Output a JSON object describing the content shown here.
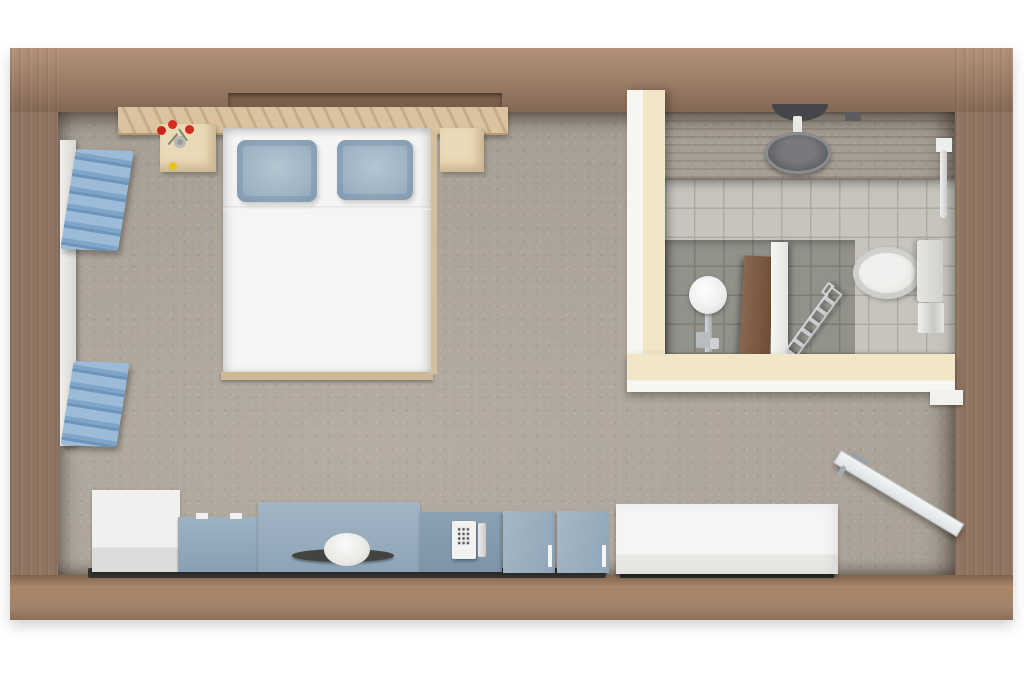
{
  "scene": {
    "type": "3d-floor-plan-top-view",
    "description": "Top-down 3D render of a studio hotel room with bedroom, kitchenette counter, entry door and en-suite bathroom inside a wooden shell",
    "background": "#ffffff"
  },
  "palette": {
    "wall_wood": "#8f7461",
    "wall_wood_light": "#b29178",
    "wall_wood_dark": "#6e5846",
    "floor_carpet": "#aba297",
    "plywood_cream": "#f1e7c7",
    "panel_white": "#f3f3f0",
    "cabinet_blue": "#93aabd",
    "cabinet_blue_dark": "#8196ab",
    "pillow_blue": "#a0b4c4",
    "towel_blue": "#8fb2d3",
    "tile_light": "#c6c4bc",
    "tile_dark": "#92918a",
    "fixture_white": "#eceff0",
    "chrome": "#b9bdc0",
    "flower_red": "#d42a20",
    "flower_yellow": "#e6c31f",
    "headboard_wood": "#dcc3a0",
    "sink_tray_dark": "#434340",
    "bathroom_door_wood": "#7d5a42"
  },
  "rooms": {
    "bedroom": {
      "label": "Bedroom area with double bed"
    },
    "bathroom": {
      "label": "Tiled bathroom with shower, toilet and basin"
    },
    "kitchenette": {
      "label": "Kitchenette counter row along bottom wall"
    },
    "entry": {
      "label": "Entry corner with open door"
    }
  },
  "furniture": {
    "bed": {
      "label": "Double bed with white duvet"
    },
    "pillow_left": {
      "label": "Left blue pillow"
    },
    "pillow_right": {
      "label": "Right blue pillow"
    },
    "headboard": {
      "label": "Wood slat headboard shelf"
    },
    "nightstand_left": {
      "label": "Left nightstand with red flowers"
    },
    "nightstand_right": {
      "label": "Right nightstand"
    },
    "flowers": {
      "label": "Vase with red and yellow flowers, top view"
    },
    "towel_shelves": {
      "label": "Wall board with stacked blue towels"
    },
    "cabinet_white": {
      "label": "White base cabinet"
    },
    "cabinet_blue_small": {
      "label": "Small blue cabinet with handles"
    },
    "vanity": {
      "label": "Blue vanity cabinet"
    },
    "vanity_sink": {
      "label": "Round white basin on dark tray"
    },
    "phone_cabinet": {
      "label": "Blue cabinet with wall phone"
    },
    "phone": {
      "label": "White telephone with keypad"
    },
    "leaning_panels": {
      "label": "Two leaning blue panels with handles"
    },
    "sideboard": {
      "label": "Long white sideboard"
    },
    "entry_door": {
      "label": "White entry door, open inward"
    },
    "door_jamb": {
      "label": "White door jamb"
    },
    "bath_wall_left": {
      "label": "Cream plywood bathroom wall, left"
    },
    "bath_wall_bottom": {
      "label": "Cream plywood bathroom wall, bottom"
    },
    "shower": {
      "label": "Rain shower head on top wall"
    },
    "toilet": {
      "label": "Toilet with tank against right wall"
    },
    "toilet_bin": {
      "label": "Small bin beside toilet"
    },
    "pedestal_sink": {
      "label": "Pedestal wash basin"
    },
    "towel_ladder": {
      "label": "Leaning chrome towel ladder"
    },
    "towel_rail": {
      "label": "Vertical towel rail on right wall"
    },
    "partition": {
      "label": "White shower partition stub"
    },
    "bathroom_door": {
      "label": "Wooden bathroom door, ajar"
    }
  }
}
